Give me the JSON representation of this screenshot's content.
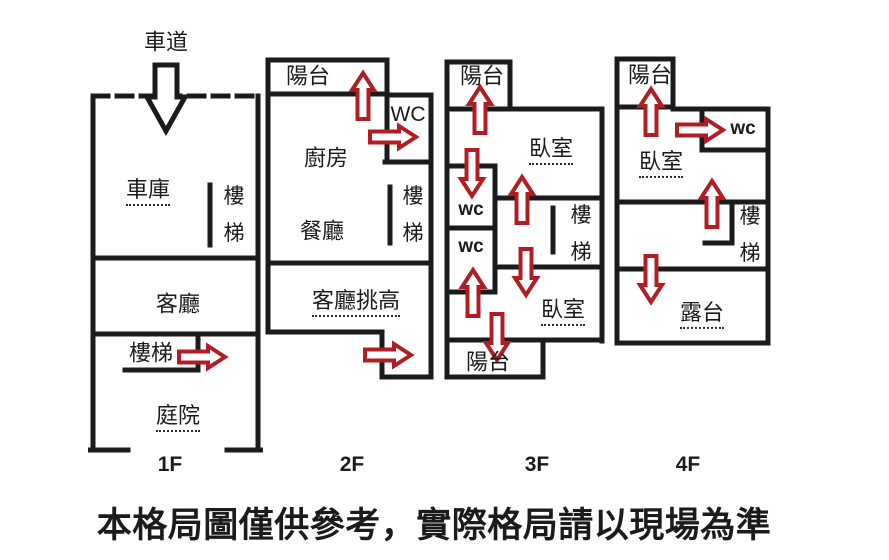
{
  "colors": {
    "wall": "#1b1b1b",
    "arrow_red": "#b01e24",
    "background": "#ffffff"
  },
  "floors": [
    {
      "label": "1F",
      "rooms": {
        "driveway": "車道",
        "garage": "車庫",
        "stairs_upper": "樓梯",
        "living_room": "客廳",
        "stairs_lower": "樓梯",
        "courtyard": "庭院"
      }
    },
    {
      "label": "2F",
      "rooms": {
        "balcony": "陽台",
        "wc": "WC",
        "kitchen": "廚房",
        "dining_room": "餐廳",
        "stairs": "樓梯",
        "living_room_double_height": "客廳挑高"
      }
    },
    {
      "label": "3F",
      "rooms": {
        "balcony_front": "陽台",
        "bedroom_front": "臥室",
        "wc_1": "wc",
        "wc_2": "wc",
        "stairs": "樓梯",
        "bedroom_rear": "臥室",
        "balcony_rear": "陽台"
      }
    },
    {
      "label": "4F",
      "rooms": {
        "balcony": "陽台",
        "wc": "wc",
        "bedroom": "臥室",
        "stairs": "樓梯",
        "terrace": "露台"
      }
    }
  ],
  "arrows": {
    "driveway_entry": {
      "floor": "1F",
      "direction": "down",
      "color": "black"
    },
    "red": [
      {
        "floor": "1F",
        "direction": "right"
      },
      {
        "floor": "2F",
        "direction": "up"
      },
      {
        "floor": "2F",
        "direction": "right"
      },
      {
        "floor": "2F",
        "direction": "right"
      },
      {
        "floor": "3F",
        "direction": "up"
      },
      {
        "floor": "3F",
        "direction": "down"
      },
      {
        "floor": "3F",
        "direction": "up"
      },
      {
        "floor": "3F",
        "direction": "up"
      },
      {
        "floor": "3F",
        "direction": "down"
      },
      {
        "floor": "3F",
        "direction": "down"
      },
      {
        "floor": "4F",
        "direction": "up"
      },
      {
        "floor": "4F",
        "direction": "right"
      },
      {
        "floor": "4F",
        "direction": "up"
      },
      {
        "floor": "4F",
        "direction": "down"
      }
    ]
  },
  "disclaimer": "本格局圖僅供參考，實際格局請以現場為準"
}
